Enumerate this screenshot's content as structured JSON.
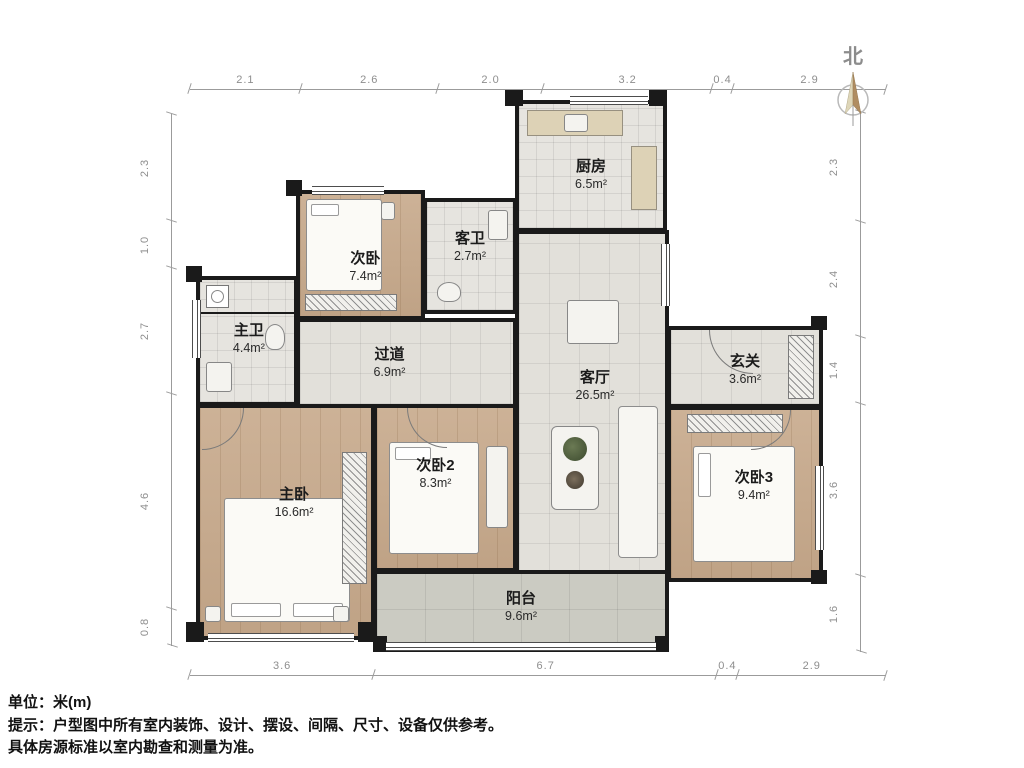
{
  "north_label": "北",
  "dimensions": {
    "unit_note": "米(m)",
    "top": [
      "2.1",
      "2.6",
      "2.0",
      "3.2",
      "0.4",
      "2.9"
    ],
    "bottom": [
      "3.6",
      "6.7",
      "0.4",
      "2.9"
    ],
    "left": [
      "2.3",
      "1.0",
      "2.7",
      "4.6",
      "0.8"
    ],
    "right": [
      "2.3",
      "2.4",
      "1.4",
      "3.6",
      "1.6"
    ]
  },
  "rooms": [
    {
      "name": "厨房",
      "area": "6.5m²"
    },
    {
      "name": "客卫",
      "area": "2.7m²"
    },
    {
      "name": "次卧",
      "area": "7.4m²"
    },
    {
      "name": "主卫",
      "area": "4.4m²"
    },
    {
      "name": "过道",
      "area": "6.9m²"
    },
    {
      "name": "客厅",
      "area": "26.5m²"
    },
    {
      "name": "玄关",
      "area": "3.6m²"
    },
    {
      "name": "主卧",
      "area": "16.6m²"
    },
    {
      "name": "次卧2",
      "area": "8.3m²"
    },
    {
      "name": "次卧3",
      "area": "9.4m²"
    },
    {
      "name": "阳台",
      "area": "9.6m²"
    }
  ],
  "footer": {
    "line1": "单位：米(m)",
    "line2": "提示：户型图中所有室内装饰、设计、摆设、间隔、尺寸、设备仅供参考。",
    "line3": "具体房源标准以室内勘查和测量为准。"
  },
  "palette": {
    "wall": "#1a1a1a",
    "wood_floor": "#c7a98b",
    "tile_floor": "#e2e0da",
    "balcony_floor": "#cbcbc2",
    "dimension_text": "#8e8e8e",
    "label_text": "#1b1b1b",
    "compass_light": "#ded6b8",
    "compass_dark": "#b08d62"
  }
}
